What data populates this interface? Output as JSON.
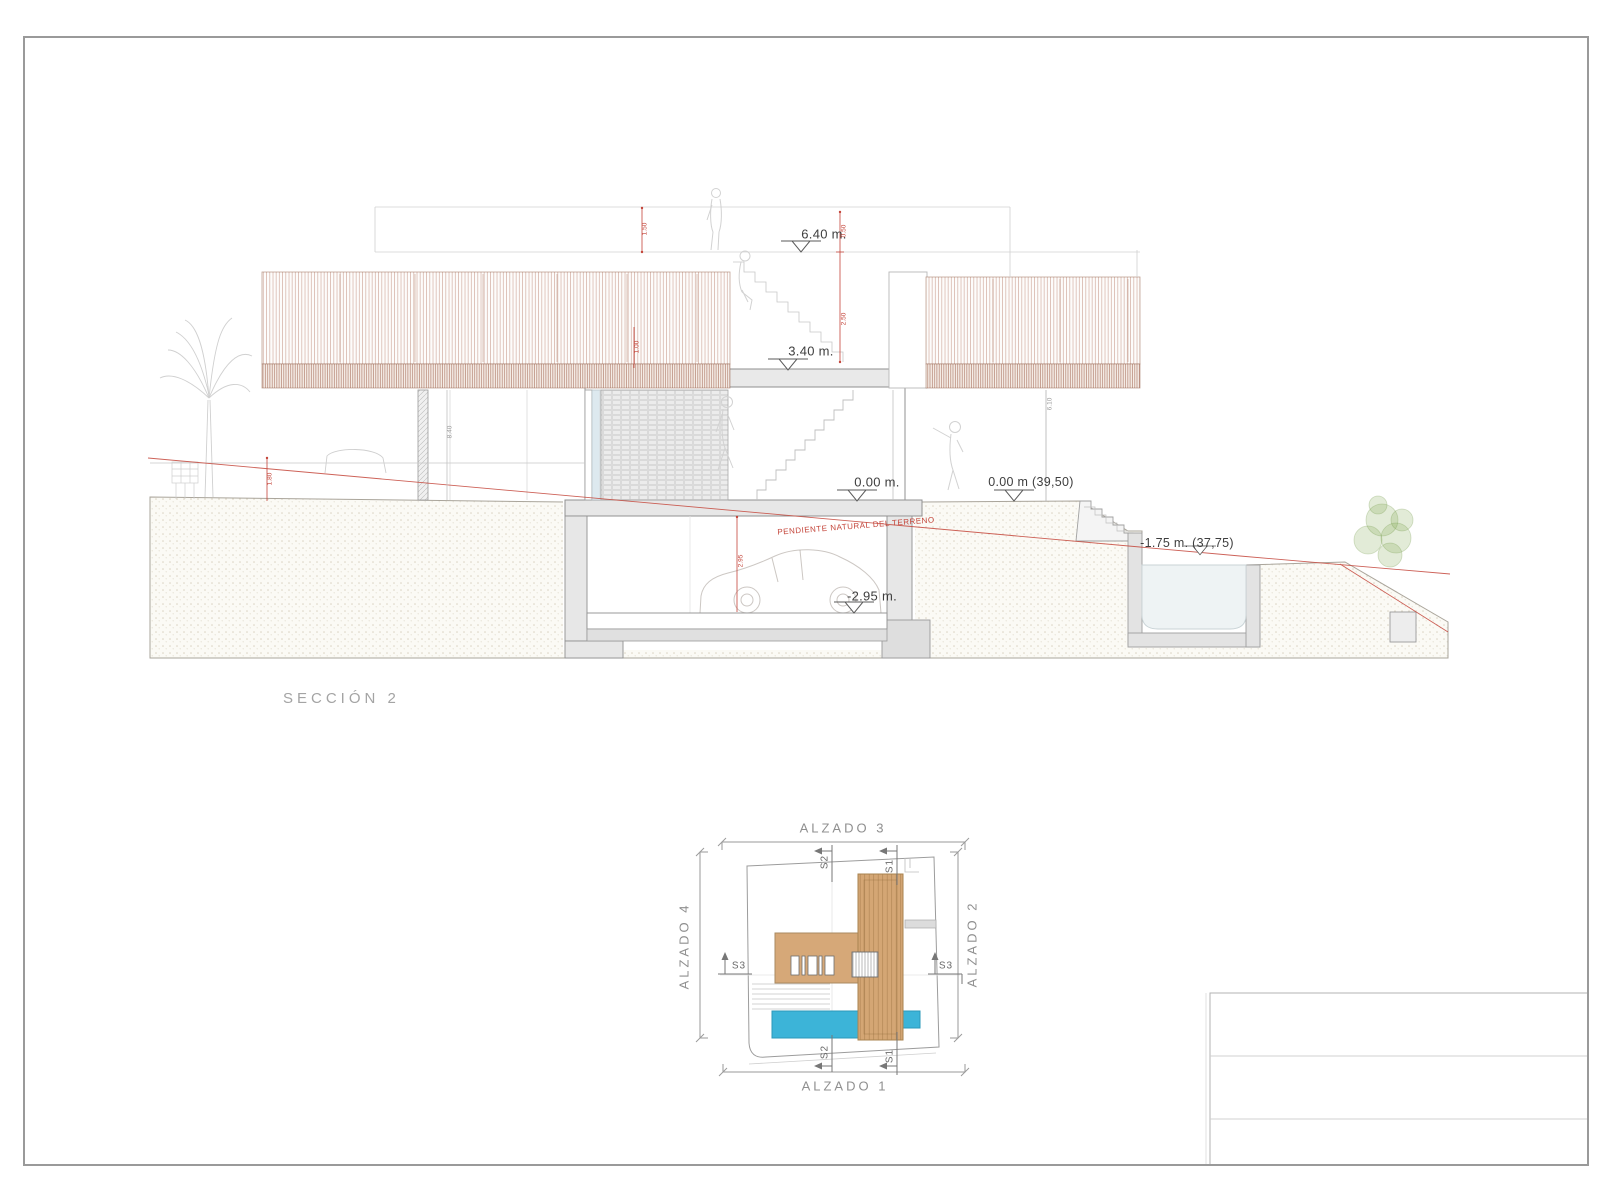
{
  "sheet": {
    "section_title": "SECCIÓN 2"
  },
  "section": {
    "levels": {
      "roof": "6.40 m.",
      "first": "3.40 m.",
      "ground": "0.00 m.",
      "ground_abs": "0.00 m (39,50)",
      "pool": "-1.75 m. (37,75)",
      "basement": "-2.95 m."
    },
    "terrain_note": "PENDIENTE NATURAL DEL TERRENO",
    "dims": {
      "d150": "1.50",
      "d050": "0.50",
      "d250": "2.50",
      "d100": "1.00",
      "d295": "2.95",
      "d180": "1.80",
      "d610": "6.10",
      "d840": "8.40"
    }
  },
  "plan": {
    "elevations": {
      "top": "ALZADO 3",
      "right": "ALZADO 2",
      "bottom": "ALZADO 1",
      "left": "ALZADO 4"
    },
    "sections": {
      "s1": "S1",
      "s2": "S2",
      "s3": "S3"
    }
  },
  "colors": {
    "accent_red": "#c4453a",
    "slat_brown": "#a8624a",
    "wood_tan": "#d6a878",
    "pool_blue": "#3cb4d8",
    "pool_water": "#eef3f4",
    "structure_gray": "#e7e7e7"
  }
}
